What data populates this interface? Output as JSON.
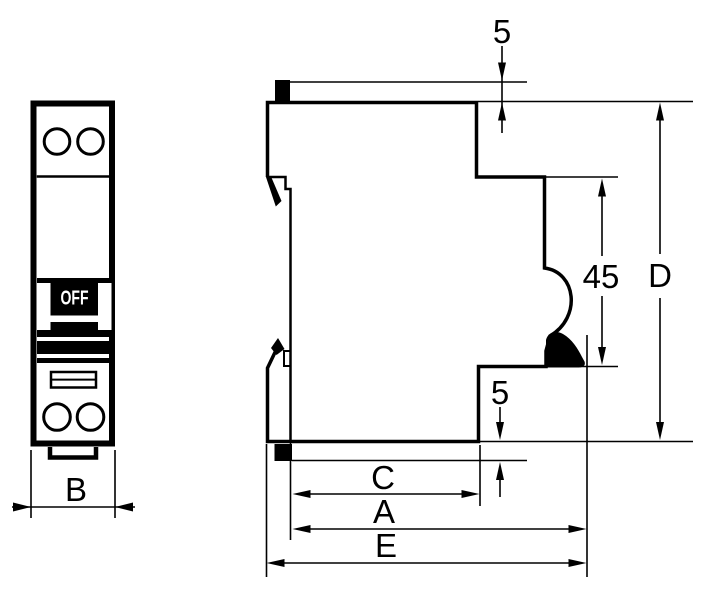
{
  "diagram": {
    "type": "technical-dimension-drawing",
    "subject": "DIN-rail circuit breaker outline drawing, front view and side view",
    "front_view": {
      "switch_state": "OFF",
      "width_dim_label": "B"
    },
    "side_view": {
      "dim_top_clip": "5",
      "dim_bottom_clip": "5",
      "dim_notch_height": "45",
      "dim_overall_height": "D",
      "dim_body_depth": "C",
      "dim_mount_depth": "A",
      "dim_overall_depth": "E"
    },
    "colors": {
      "line": "#000000",
      "background": "#ffffff",
      "label_text": "#000000",
      "switch_text": "#ffffff",
      "switch_handle": "#000000"
    }
  }
}
